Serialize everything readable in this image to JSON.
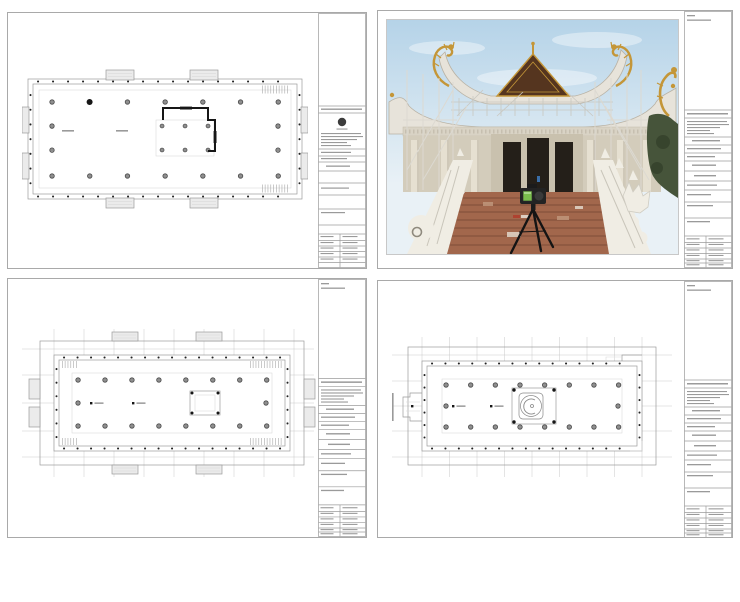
{
  "document": {
    "kind": "architectural-drawing-set",
    "sheet_count": 4
  },
  "sheets": [
    {
      "name": "ground-floor-plan-sheet",
      "content": "floor-plan-drawing"
    },
    {
      "name": "construction-site-photo-sheet",
      "content": "temple-photo-with-laser-scanner"
    },
    {
      "name": "upper-floor-plan-sheet",
      "content": "floor-plan-drawing"
    },
    {
      "name": "roof-plan-sheet",
      "content": "floor-plan-drawing"
    }
  ],
  "colors": {
    "canvas": "#ffffff",
    "sheet_border": "#a9a9a9",
    "plan_line": "#9b9b9b",
    "plan_faint": "#d9d9d9",
    "plan_grid": "#c9c9c9",
    "plan_dark": "#161616",
    "hatch_fill": "#ebebeb",
    "text_mark": "#9a9a9a",
    "logo_dark": "#3c3c3c",
    "sky_top": "#b5d3e8",
    "sky_bottom": "#e9f1f6",
    "gold": "#c49638",
    "roof_gable": "#55351f",
    "concrete_light": "#e7e3da",
    "concrete_mid": "#d3ccbb",
    "concrete_dark": "#b9b2a4",
    "doorway": "#241f19",
    "brick": "#a2674c",
    "brick_line": "#7f4e38",
    "statue": "#f0ede4",
    "statue_shade": "#c9c5ba",
    "foliage": "#46543a",
    "foliage_dark": "#333f2a",
    "scanner_body": "#232323",
    "scanner_screen": "#79bd4c",
    "debris_red": "#b23a2a",
    "person_blue": "#3a6ea8"
  }
}
